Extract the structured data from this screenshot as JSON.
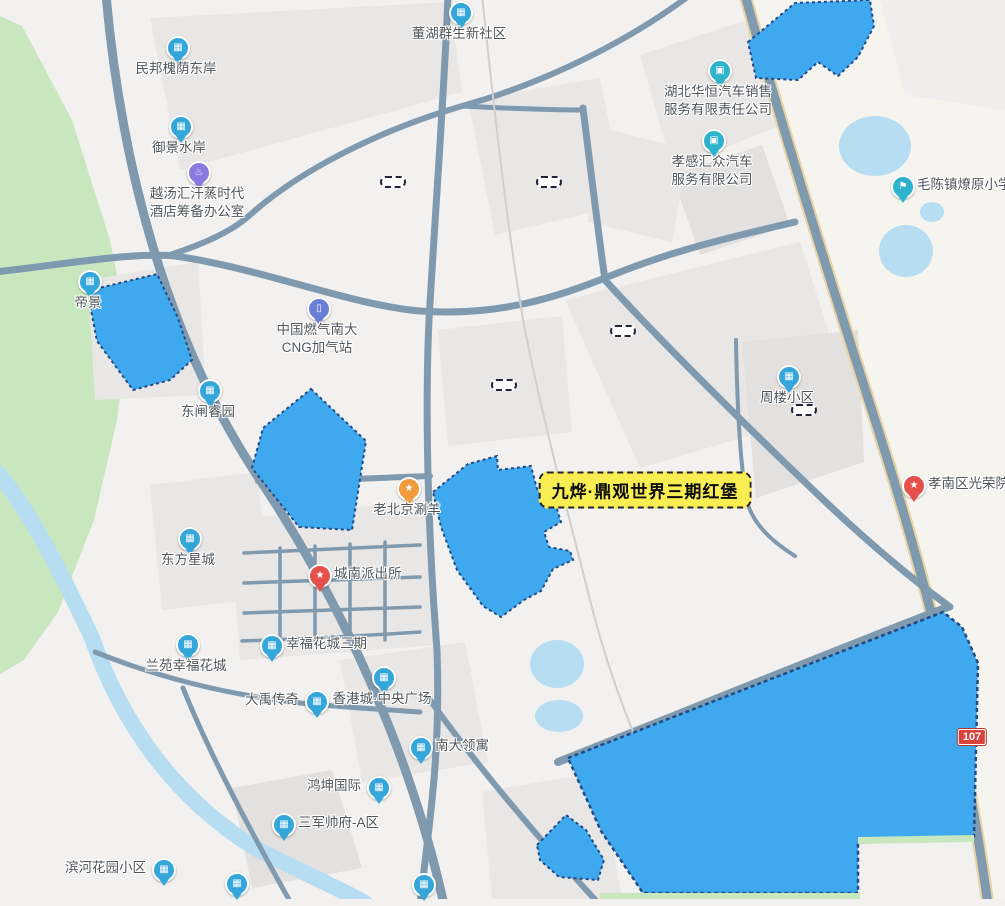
{
  "colors": {
    "highlight_blue": "#3fa9f0",
    "highlight_border": "#224a86",
    "water": "#b7ddf2",
    "park_green": "#c9e7bf",
    "road_slate": "#7f99af",
    "road_tan": "#e6d3a3",
    "promo_yellow": "#f8ee52"
  },
  "icons": {
    "building": "▦",
    "car": "▣",
    "school": "⚑",
    "police": "★",
    "star": "★",
    "gas": "▯",
    "spa": "♨",
    "food": "★"
  },
  "map": {
    "route_badge": "107",
    "pois": [
      {
        "id": "poi-minbang-huaiyin-dongan",
        "lines": [
          "民邦槐荫东岸"
        ],
        "x": 176,
        "y": 46,
        "side": "below",
        "icon": "building"
      },
      {
        "id": "poi-yujing-shuian",
        "lines": [
          "御景水岸"
        ],
        "x": 179,
        "y": 125,
        "side": "below",
        "icon": "building"
      },
      {
        "id": "poi-yuetanghui-spa",
        "lines": [
          "越汤汇汗蒸时代",
          "酒店筹备办公室"
        ],
        "x": 197,
        "y": 171,
        "side": "below",
        "icon": "spa",
        "color": "#8a7ae0"
      },
      {
        "id": "poi-donghu-qunsheng",
        "lines": [
          "董湖群生新社区"
        ],
        "x": 459,
        "y": 11,
        "side": "below",
        "icon": "building"
      },
      {
        "id": "poi-hubei-huaheng-auto",
        "lines": [
          "湖北华恒汽车销售",
          "服务有限责任公司"
        ],
        "x": 718,
        "y": 69,
        "side": "below",
        "icon": "car",
        "color": "#2fb3cc"
      },
      {
        "id": "poi-xiaogan-huizhong-auto",
        "lines": [
          "孝感汇众汽车",
          "服务有限公司"
        ],
        "x": 712,
        "y": 139,
        "side": "below",
        "icon": "car",
        "color": "#2fb3cc"
      },
      {
        "id": "poi-maochen-liaoyuan-school",
        "lines": [
          "毛陈镇燎原小学"
        ],
        "x": 901,
        "y": 185,
        "side": "right",
        "icon": "school",
        "color": "#2fb3cc"
      },
      {
        "id": "poi-dijing",
        "lines": [
          "帝景"
        ],
        "x": 88,
        "y": 280,
        "side": "below",
        "icon": "building"
      },
      {
        "id": "poi-cng-station",
        "lines": [
          "中国燃气南大",
          "CNG加气站"
        ],
        "x": 317,
        "y": 307,
        "side": "below",
        "icon": "gas",
        "color": "#6b7fd8"
      },
      {
        "id": "poi-dongzha-ruiyuan",
        "lines": [
          "东闸睿园"
        ],
        "x": 208,
        "y": 389,
        "side": "below",
        "icon": "building"
      },
      {
        "id": "poi-zhoulou-map-text",
        "lines": [
          "周楼小区"
        ],
        "x": 787,
        "y": 375,
        "side": "below",
        "icon": "building"
      },
      {
        "id": "poi-laobeijing-shuanyang",
        "lines": [
          "老北京涮羊"
        ],
        "x": 407,
        "y": 487,
        "side": "below",
        "icon": "food",
        "color": "#f29b3d"
      },
      {
        "id": "poi-dongfang-xingcheng",
        "lines": [
          "东方星城"
        ],
        "x": 188,
        "y": 537,
        "side": "below",
        "icon": "building"
      },
      {
        "id": "poi-chengnan-police",
        "lines": [
          "城南派出所"
        ],
        "x": 318,
        "y": 574,
        "side": "right",
        "icon": "police",
        "color": "#e4514d"
      },
      {
        "id": "poi-xingfu-huacheng-3",
        "lines": [
          "幸福花城三期"
        ],
        "x": 270,
        "y": 644,
        "side": "right",
        "icon": "building"
      },
      {
        "id": "poi-lanyuan-xingfu",
        "lines": [
          "兰苑幸福花城"
        ],
        "x": 186,
        "y": 643,
        "side": "below",
        "icon": "building"
      },
      {
        "id": "poi-dayu-chuanqi",
        "lines": [
          "大禹传奇"
        ],
        "x": 315,
        "y": 700,
        "side": "left",
        "icon": "building"
      },
      {
        "id": "poi-xianggang-plaza",
        "lines": [
          "香港城·中央广场"
        ],
        "x": 382,
        "y": 676,
        "side": "below",
        "icon": "building"
      },
      {
        "id": "poi-nanda-lingyu",
        "lines": [
          "南大领寓"
        ],
        "x": 419,
        "y": 746,
        "side": "right",
        "icon": "building"
      },
      {
        "id": "poi-hongkun-intl",
        "lines": [
          "鸿坤国际"
        ],
        "x": 377,
        "y": 786,
        "side": "left",
        "icon": "building"
      },
      {
        "id": "poi-sanjun-shuaifu",
        "lines": [
          "三军帅府-A区"
        ],
        "x": 282,
        "y": 823,
        "side": "right",
        "icon": "building"
      },
      {
        "id": "poi-binhe-huayuan",
        "lines": [
          "滨河花园小区"
        ],
        "x": 162,
        "y": 868,
        "side": "left",
        "icon": "building"
      },
      {
        "id": "poi-xiaonan-guangrongyuan",
        "lines": [
          "孝南区光荣院"
        ],
        "x": 912,
        "y": 484,
        "side": "right",
        "icon": "star",
        "color": "#e4514d"
      },
      {
        "id": "poi-bottom-edge-1",
        "lines": [],
        "x": 235,
        "y": 882,
        "side": "below",
        "icon": "building"
      },
      {
        "id": "poi-bottom-edge-2",
        "lines": [],
        "x": 422,
        "y": 883,
        "side": "below",
        "icon": "building"
      }
    ],
    "dashed_labels": [
      {
        "id": "label-minbang-huaiyin-dongan",
        "text": "民邦槐荫东岸",
        "cx": 393,
        "cy": 182
      },
      {
        "id": "label-saida-kangcheng",
        "text": "赛达康城",
        "cx": 549,
        "cy": 182
      },
      {
        "id": "label-dingguan-phase1",
        "text": "鼎观世界一期",
        "cx": 623,
        "cy": 331
      },
      {
        "id": "label-dingguan-phase2",
        "text": "鼎观世界二期",
        "cx": 504,
        "cy": 385
      },
      {
        "id": "label-zhoulou-xiaoqu",
        "text": "周楼小区",
        "cx": 804,
        "cy": 410
      }
    ],
    "promo_label": {
      "id": "label-jiuye-dingguan-phase3",
      "text": "九烨·鼎观世界三期红堡",
      "cx": 645,
      "cy": 490
    },
    "highlights": [
      {
        "id": "hl-dongnan-hospital",
        "text": "东南医院",
        "cx": 806,
        "cy": 44,
        "rotate": -33,
        "size": 26
      },
      {
        "id": "hl-wanda-plaza",
        "text": "万达广场",
        "cx": 141,
        "cy": 331,
        "rotate": 38,
        "size": 25
      },
      {
        "id": "hl-nanda-jiancai",
        "text": "南大建材家居",
        "cx": 307,
        "cy": 458,
        "rotate": 52,
        "size": 20
      },
      {
        "id": "hl-huaiyin-station",
        "text": "槐荫站",
        "cx": 496,
        "cy": 536,
        "rotate": 62,
        "size": 23,
        "spacing": 9
      },
      {
        "id": "hl-shiyan-erxiao",
        "text": "实验二小",
        "cx": 569,
        "cy": 846,
        "rotate": 47,
        "size": 16
      },
      {
        "id": "hl-xiannvhu-park",
        "text": "仙女湖公园",
        "cx": 788,
        "cy": 763,
        "rotate": 0,
        "size": 30,
        "spacing": 16
      }
    ],
    "road_labels": [
      {
        "id": "road-dongyonglu",
        "text": "董永路",
        "x": 117,
        "y": -8,
        "rotate": 14,
        "vertical": true
      },
      {
        "id": "road-dongzhalu",
        "text": "东闸路",
        "x": 585,
        "y": 279,
        "rotate": -18
      },
      {
        "id": "road-xiannvhu-beilu",
        "text": "仙女湖北路",
        "x": 668,
        "y": 706,
        "rotate": -21,
        "white": true
      }
    ],
    "partial_texts": [
      {
        "id": "text-zhongdu-balicheng",
        "text": "中都巴黎城·2期",
        "x": 331,
        "y": 1,
        "size": 15
      },
      {
        "id": "text-yuan",
        "text": "院",
        "x": 845,
        "y": 48,
        "size": 15
      },
      {
        "id": "text-sai",
        "text": "赛",
        "x": 482,
        "y": 180,
        "size": 15
      },
      {
        "id": "text-shijie",
        "text": "世界",
        "x": 690,
        "y": 322,
        "size": 14
      },
      {
        "id": "text-xiaogan-clip",
        "text": "孝感",
        "x": 982,
        "y": 530,
        "size": 14
      },
      {
        "id": "text-fu-clip",
        "text": "服",
        "x": 995,
        "y": 550,
        "size": 14
      },
      {
        "id": "text-shiyan-xiaoxue",
        "text": "实验小学",
        "x": 575,
        "y": 881,
        "size": 14
      }
    ]
  }
}
